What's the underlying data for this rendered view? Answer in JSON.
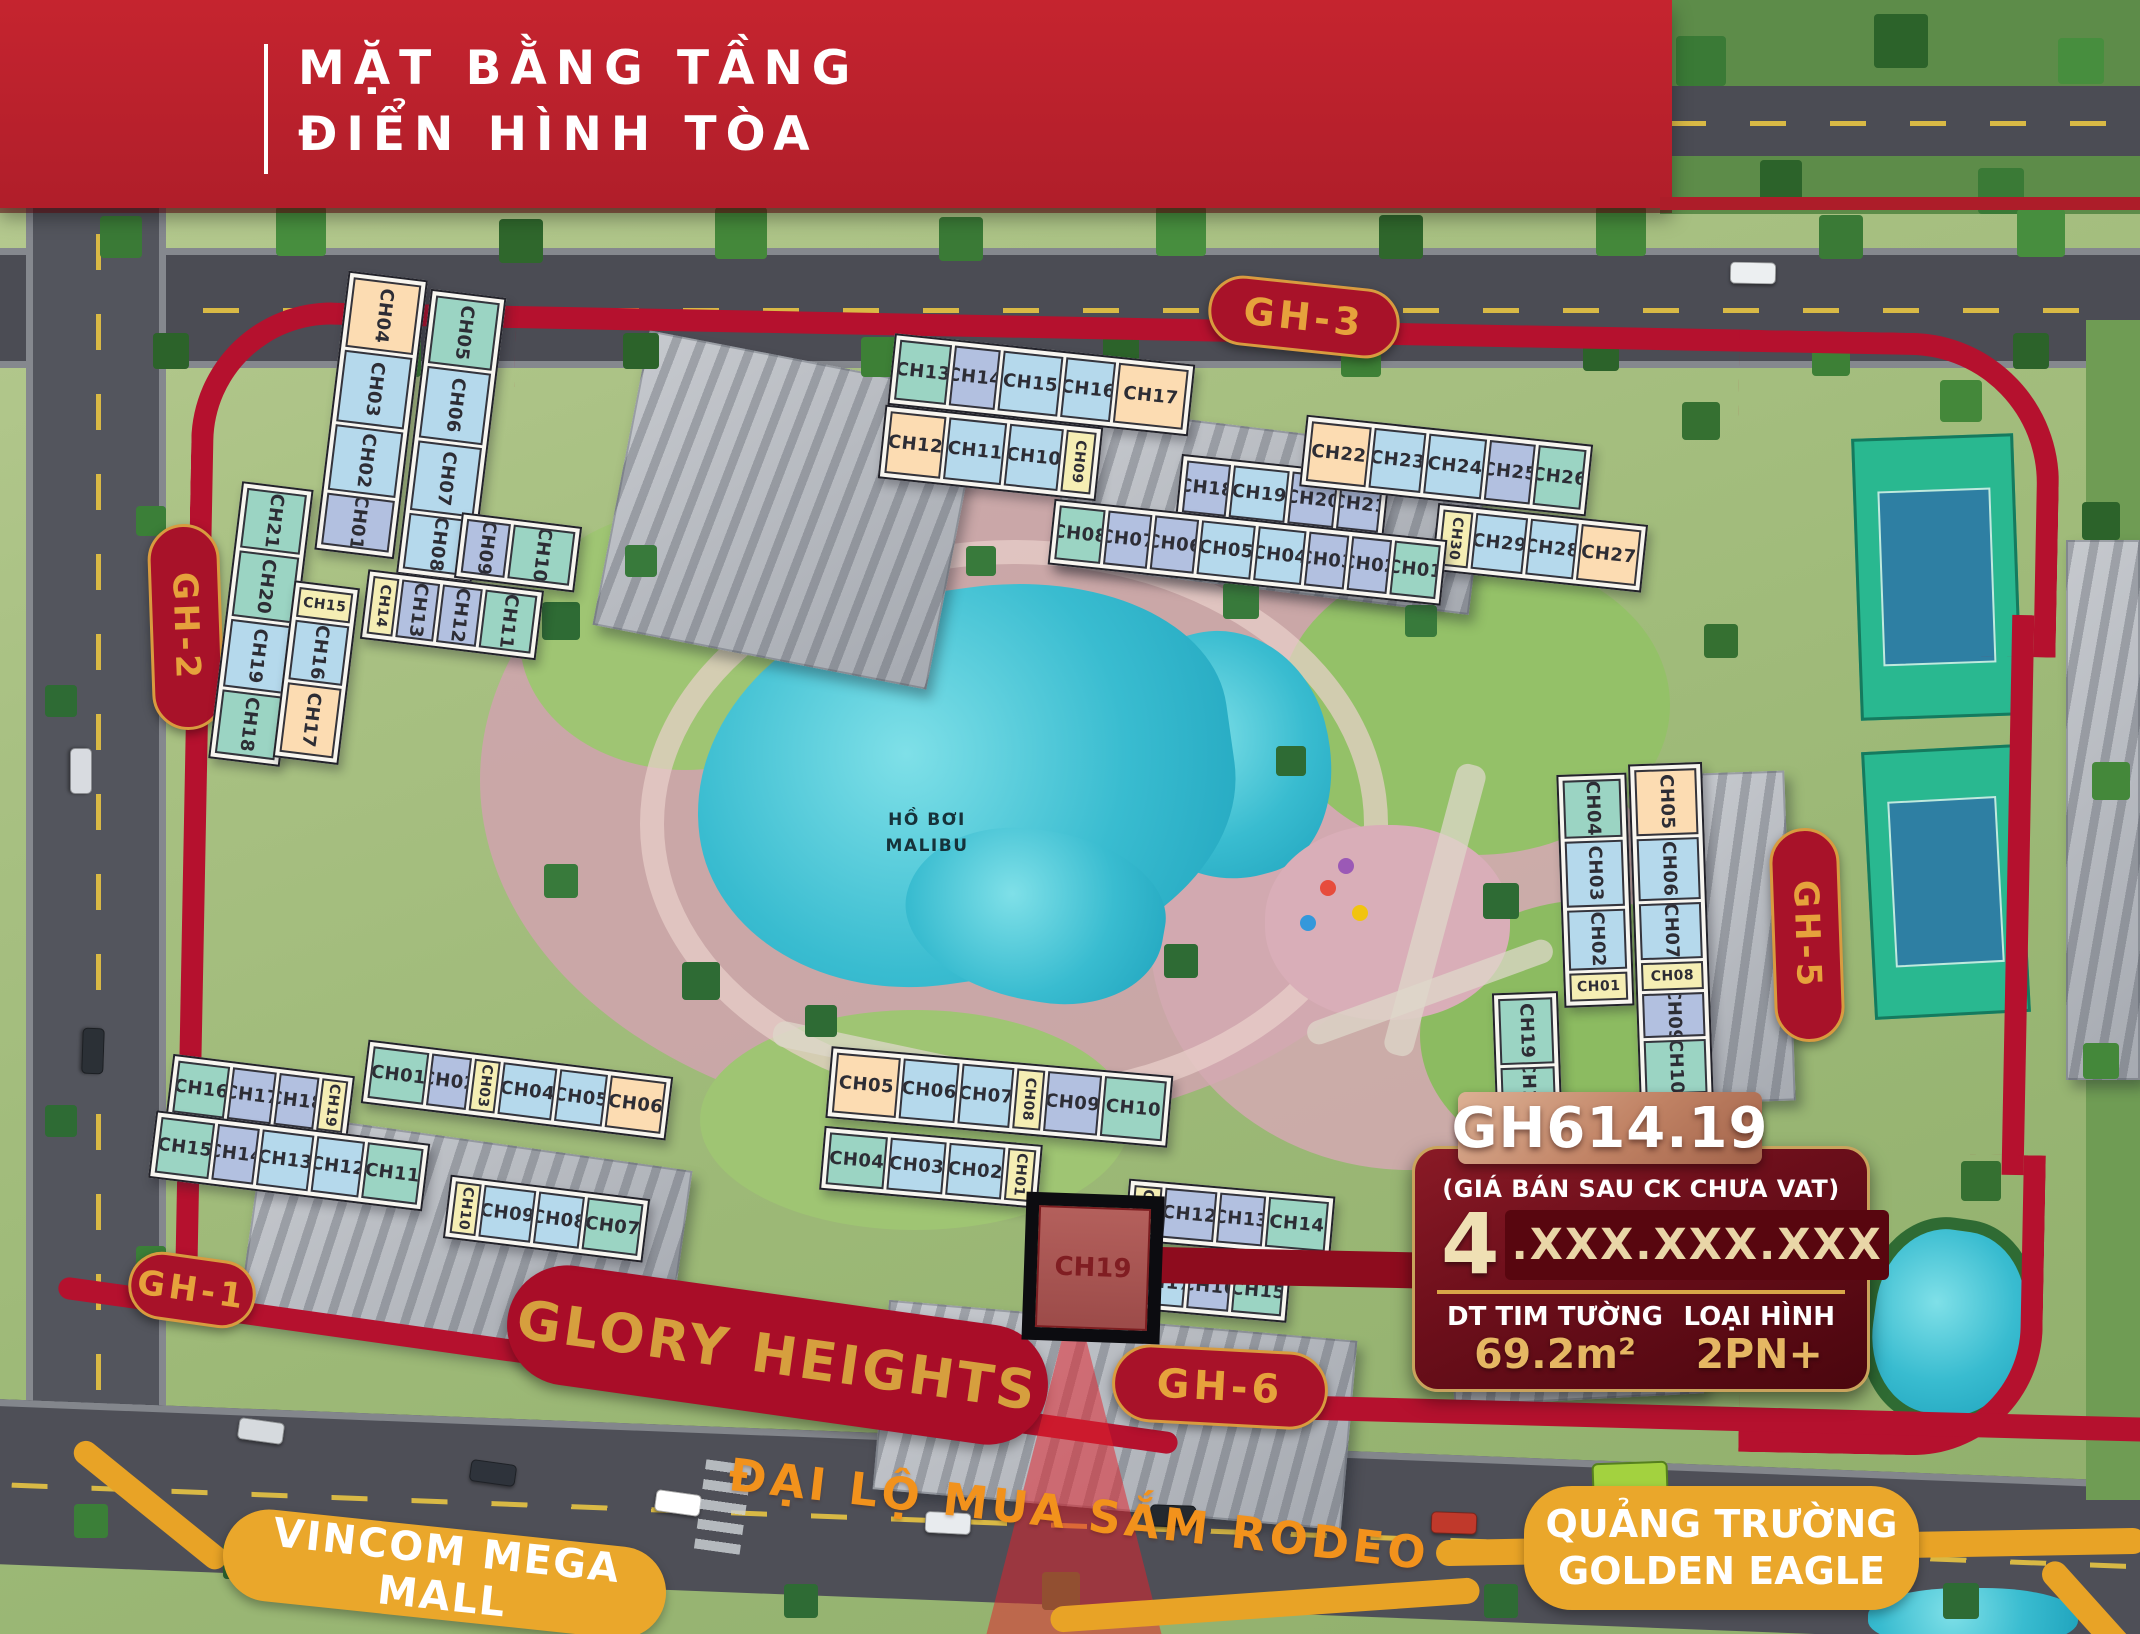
{
  "banner": {
    "title_line1": "MẶT BẰNG TẦNG",
    "title_line2": "ĐIỂN HÌNH TÒA"
  },
  "labels": {
    "gh1": "GH-1",
    "gh2": "GH-2",
    "gh3": "GH-3",
    "gh5": "GH-5",
    "gh6": "GH-6",
    "glory": "GLORY HEIGHTS",
    "rodeo": "ĐẠI LỘ MUA SẮM RODEO",
    "vincom": "VINCOM MEGA MALL",
    "square_line1": "QUẢNG TRƯỜNG",
    "square_line2": "GOLDEN EAGLE",
    "pool_line1": "HỒ BƠI",
    "pool_line2": "MALIBU"
  },
  "highlight_unit": "CH19",
  "info_card": {
    "code": "GH614.19",
    "price_note": "(GIÁ BÁN SAU CK CHƯA VAT)",
    "price_lead": "4",
    "price_masked": ".XXX.XXX.XXX",
    "area_label": "DT TIM TƯỜNG",
    "area_value": "69.2m²",
    "type_label": "LOẠI HÌNH",
    "type_value": "2PN+"
  },
  "colors": {
    "banner_red": "#bf2430",
    "route_red": "#b5112e",
    "badge_bg": "#a81229",
    "badge_text": "#e6a23c",
    "amber": "#eaa72b",
    "card_bg": "#6d0f1b",
    "gold": "#d9a648",
    "pool": "#39bcd0",
    "unit_teal": "#9bd4c3",
    "unit_blue": "#b5d9ec",
    "unit_lavender": "#b2c0e0",
    "unit_yellow": "#f5eeb4",
    "unit_peach": "#fcdcb2",
    "highlight_fill": "#b05c58"
  },
  "buildings": {
    "gh2": {
      "colA1": [
        {
          "id": "CH04",
          "c": "peach",
          "h": 70,
          "v": 1
        },
        {
          "id": "CH03",
          "c": "blue",
          "h": 72,
          "v": 1
        },
        {
          "id": "CH02",
          "c": "blue",
          "h": 66,
          "v": 1
        },
        {
          "id": "CH01",
          "c": "lav",
          "h": 52,
          "v": 1
        }
      ],
      "colA2": [
        {
          "id": "CH05",
          "c": "teal",
          "h": 68,
          "v": 1
        },
        {
          "id": "CH06",
          "c": "blue",
          "h": 72,
          "v": 1
        },
        {
          "id": "CH07",
          "c": "blue",
          "h": 70,
          "v": 1
        },
        {
          "id": "CH08",
          "c": "blue",
          "h": 56,
          "v": 1
        }
      ],
      "rowB1": [
        {
          "id": "CH09",
          "c": "lav",
          "w": 44,
          "v": 1
        },
        {
          "id": "CH10",
          "c": "teal",
          "w": 62,
          "v": 1
        }
      ],
      "rowB2": [
        {
          "id": "CH14",
          "c": "yellow",
          "w": 26,
          "v": 1
        },
        {
          "id": "CH13",
          "c": "lav",
          "w": 38,
          "v": 1
        },
        {
          "id": "CH12",
          "c": "lav",
          "w": 40,
          "v": 1
        },
        {
          "id": "CH11",
          "c": "teal",
          "w": 52,
          "v": 1
        }
      ],
      "colC1": [
        {
          "id": "CH21",
          "c": "teal",
          "h": 60,
          "v": 1
        },
        {
          "id": "CH20",
          "c": "teal",
          "h": 66,
          "v": 1
        },
        {
          "id": "CH19",
          "c": "blue",
          "h": 68,
          "v": 1
        },
        {
          "id": "CH18",
          "c": "teal",
          "h": 64,
          "v": 1
        }
      ],
      "colC2": [
        {
          "id": "CH15",
          "c": "yellow",
          "h": 30
        },
        {
          "id": "CH16",
          "c": "blue",
          "h": 60,
          "v": 1
        },
        {
          "id": "CH17",
          "c": "peach",
          "h": 70,
          "v": 1
        }
      ]
    },
    "gh3": {
      "rowT1": [
        {
          "id": "CH13",
          "c": "teal",
          "w": 52
        },
        {
          "id": "CH14",
          "c": "lav",
          "w": 46
        },
        {
          "id": "CH15",
          "c": "blue",
          "w": 60
        },
        {
          "id": "CH16",
          "c": "blue",
          "w": 50
        },
        {
          "id": "CH17",
          "c": "peach",
          "w": 70
        }
      ],
      "rowM1": [
        {
          "id": "CH12",
          "c": "peach",
          "w": 56
        },
        {
          "id": "CH11",
          "c": "blue",
          "w": 58
        },
        {
          "id": "CH10",
          "c": "blue",
          "w": 54
        },
        {
          "id": "CH09",
          "c": "yellow",
          "w": 30,
          "v": 1
        }
      ],
      "rowM2": [
        {
          "id": "CH18",
          "c": "lav",
          "w": 44
        },
        {
          "id": "CH19",
          "c": "blue",
          "w": 56
        },
        {
          "id": "CH20",
          "c": "lav",
          "w": 46
        },
        {
          "id": "CH21",
          "c": "lav",
          "w": 42
        }
      ],
      "rowT2": [
        {
          "id": "CH22",
          "c": "peach",
          "w": 60
        },
        {
          "id": "CH23",
          "c": "blue",
          "w": 52
        },
        {
          "id": "CH24",
          "c": "blue",
          "w": 58
        },
        {
          "id": "CH25",
          "c": "lav",
          "w": 46
        },
        {
          "id": "CH26",
          "c": "teal",
          "w": 48
        }
      ],
      "rowM3": [
        {
          "id": "CH30",
          "c": "yellow",
          "w": 30,
          "v": 1
        },
        {
          "id": "CH29",
          "c": "blue",
          "w": 52
        },
        {
          "id": "CH28",
          "c": "blue",
          "w": 48
        },
        {
          "id": "CH27",
          "c": "peach",
          "w": 60
        }
      ],
      "rowB": [
        {
          "id": "CH08",
          "c": "teal",
          "w": 46
        },
        {
          "id": "CH07",
          "c": "lav",
          "w": 44
        },
        {
          "id": "CH06",
          "c": "lav",
          "w": 44
        },
        {
          "id": "CH05",
          "c": "blue",
          "w": 54
        },
        {
          "id": "CH04",
          "c": "blue",
          "w": 48
        },
        {
          "id": "CH03",
          "c": "lav",
          "w": 40
        },
        {
          "id": "CH02",
          "c": "lav",
          "w": 40
        },
        {
          "id": "CH01",
          "c": "teal",
          "w": 46
        }
      ]
    },
    "gh5": {
      "colL": [
        {
          "id": "CH04",
          "c": "teal",
          "h": 58,
          "v": 1
        },
        {
          "id": "CH03",
          "c": "blue",
          "h": 66,
          "v": 1
        },
        {
          "id": "CH02",
          "c": "blue",
          "h": 60,
          "v": 1
        },
        {
          "id": "CH01",
          "c": "yellow",
          "h": 28
        }
      ],
      "colR": [
        {
          "id": "CH05",
          "c": "peach",
          "h": 66,
          "v": 1
        },
        {
          "id": "CH06",
          "c": "blue",
          "h": 62,
          "v": 1
        },
        {
          "id": "CH07",
          "c": "blue",
          "h": 56,
          "v": 1
        },
        {
          "id": "CH08",
          "c": "yellow",
          "h": 28
        },
        {
          "id": "CH09",
          "c": "lav",
          "h": 44,
          "v": 1
        },
        {
          "id": "CH10",
          "c": "teal",
          "h": 54,
          "v": 1
        }
      ],
      "colX": [
        {
          "id": "CH19",
          "c": "teal",
          "h": 66,
          "v": 1
        },
        {
          "id": "CH18",
          "c": "teal",
          "h": 42,
          "v": 1
        }
      ]
    },
    "gh1": {
      "rowL1": [
        {
          "id": "CH16",
          "c": "teal",
          "w": 52
        },
        {
          "id": "CH17",
          "c": "lav",
          "w": 44
        },
        {
          "id": "CH18",
          "c": "lav",
          "w": 40
        },
        {
          "id": "CH19",
          "c": "yellow",
          "w": 26,
          "v": 1
        }
      ],
      "rowL2": [
        {
          "id": "CH15",
          "c": "teal",
          "w": 54
        },
        {
          "id": "CH14",
          "c": "lav",
          "w": 42
        },
        {
          "id": "CH13",
          "c": "blue",
          "w": 52
        },
        {
          "id": "CH12",
          "c": "blue",
          "w": 48
        },
        {
          "id": "CH11",
          "c": "teal",
          "w": 56
        }
      ],
      "rowR1": [
        {
          "id": "CH01",
          "c": "teal",
          "w": 56
        },
        {
          "id": "CH02",
          "c": "lav",
          "w": 40
        },
        {
          "id": "CH03",
          "c": "yellow",
          "w": 26,
          "v": 1
        },
        {
          "id": "CH04",
          "c": "blue",
          "w": 54
        },
        {
          "id": "CH05",
          "c": "blue",
          "w": 48
        },
        {
          "id": "CH06",
          "c": "peach",
          "w": 56
        }
      ],
      "rowR2": [
        {
          "id": "CH10",
          "c": "yellow",
          "w": 26,
          "v": 1
        },
        {
          "id": "CH09",
          "c": "blue",
          "w": 52
        },
        {
          "id": "CH08",
          "c": "blue",
          "w": 46
        },
        {
          "id": "CH07",
          "c": "teal",
          "w": 56
        }
      ]
    },
    "gh6": {
      "rowA": [
        {
          "id": "CH05",
          "c": "peach",
          "w": 64
        },
        {
          "id": "CH06",
          "c": "blue",
          "w": 56
        },
        {
          "id": "CH07",
          "c": "blue",
          "w": 52
        },
        {
          "id": "CH08",
          "c": "yellow",
          "w": 28,
          "v": 1
        },
        {
          "id": "CH09",
          "c": "lav",
          "w": 54
        },
        {
          "id": "CH10",
          "c": "teal",
          "w": 62
        }
      ],
      "rowB": [
        {
          "id": "CH04",
          "c": "teal",
          "w": 58
        },
        {
          "id": "CH03",
          "c": "blue",
          "w": 56
        },
        {
          "id": "CH02",
          "c": "blue",
          "w": 56
        },
        {
          "id": "CH01",
          "c": "yellow",
          "w": 28,
          "v": 1
        }
      ],
      "rowC": [
        {
          "id": "CH11",
          "c": "yellow",
          "w": 28,
          "v": 1
        },
        {
          "id": "CH12",
          "c": "lav",
          "w": 52
        },
        {
          "id": "CH13",
          "c": "lav",
          "w": 46
        },
        {
          "id": "CH14",
          "c": "teal",
          "w": 60
        }
      ],
      "rowD": [
        {
          "id": "CH18",
          "c": "yellow",
          "w": 24,
          "v": 1
        },
        {
          "id": "CH17",
          "c": "blue",
          "w": 42
        },
        {
          "id": "CH16",
          "c": "lav",
          "w": 42
        },
        {
          "id": "CH15",
          "c": "teal",
          "w": 50
        }
      ]
    }
  }
}
